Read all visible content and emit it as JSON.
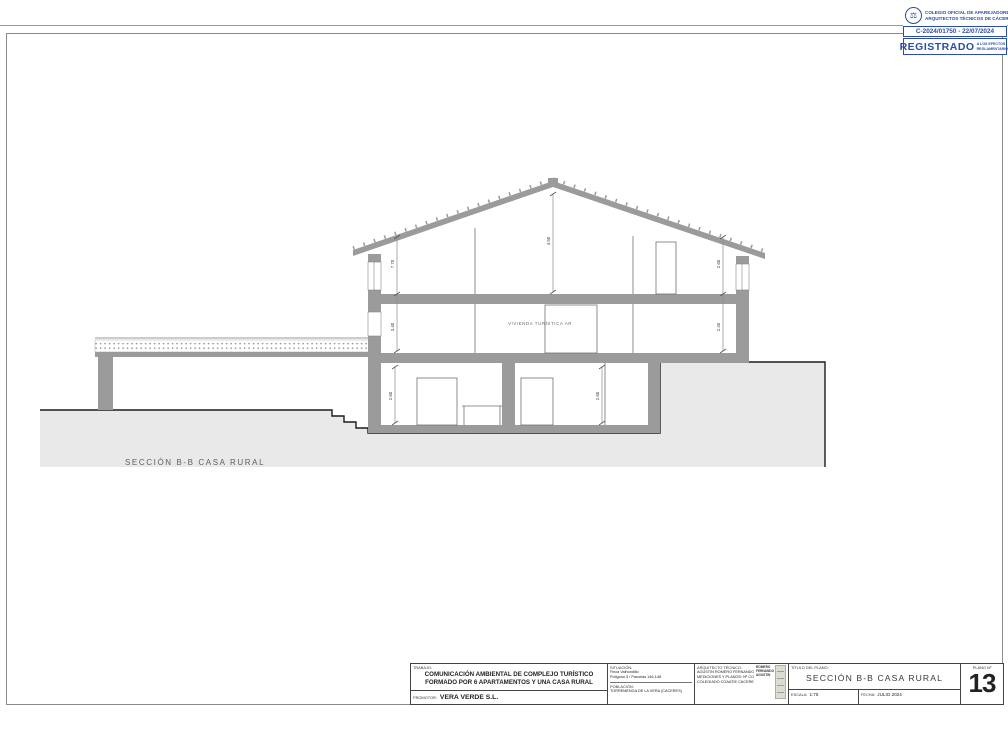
{
  "stamp": {
    "org_line1": "COLEGIO OFICIAL DE APAREJADORES",
    "org_line2": "ARQUITECTOS TÉCNICOS DE CÁCERES",
    "registration": "C-2024/01750 - 22/07/2024",
    "registered": "REGISTRADO",
    "registered_note_line1": "A LOS EFECTOS",
    "registered_note_line2": "REGLAMENTARIOS",
    "accent_color": "#2b4da5",
    "logo_glyph": "⚖"
  },
  "drawing": {
    "section_label": "SECCIÓN B-B CASA RURAL",
    "room_label": "VIVIENDA TURÍSTICA AR",
    "dims": {
      "left_upper": "7.70",
      "left_lower": "3.40",
      "ridge": "4.50",
      "right_upper": "2.60",
      "right_lower": "2.45",
      "basement_left": "2.60",
      "basement_right": "2.60"
    },
    "wall_color": "#9b9b9b",
    "terrain_color": "#e9e9e9"
  },
  "title_block": {
    "trabajo_label": "TRABAJO:",
    "trabajo_line1": "COMUNICACIÓN AMBIENTAL DE COMPLEJO TURÍSTICO",
    "trabajo_line2": "FORMADO POR 6 APARTAMENTOS Y UNA CASA RURAL",
    "promotor_label": "PROMOTOR:",
    "promotor_value": "VERA VERDE S.L.",
    "situacion_label": "SITUACIÓN:",
    "situacion_line1": "Finca Valhondillo",
    "situacion_line2": "Polígono 3 / Parcelas 146-148",
    "poblacion_label": "POBLACIÓN:",
    "poblacion_value": "TORREMENGA DE LA VERA (CÁCERES)",
    "arquitecto_label": "ARQUITECTO TÉCNICO:",
    "arquitecto_line1": "AGUSTÍN ROMERO FERNANDO",
    "arquitecto_line2": "MEDICIONES Y PLANOS: Nº COL.",
    "arquitecto_line3": "COLEGIADO COAATIE CÁCERES",
    "firma_line1": "ROMERO",
    "firma_line2": "FERNANDO",
    "firma_line3": "AGUSTIN",
    "titulo_label": "TÍTULO DEL PLANO:",
    "titulo_value": "SECCIÓN B-B CASA RURAL",
    "escala_label": "ESCALA:",
    "escala_value": "1:75",
    "fecha_label": "FECHA:",
    "fecha_value": "JULIO 2024",
    "plano_label": "PLANO Nº",
    "plano_number": "13"
  }
}
